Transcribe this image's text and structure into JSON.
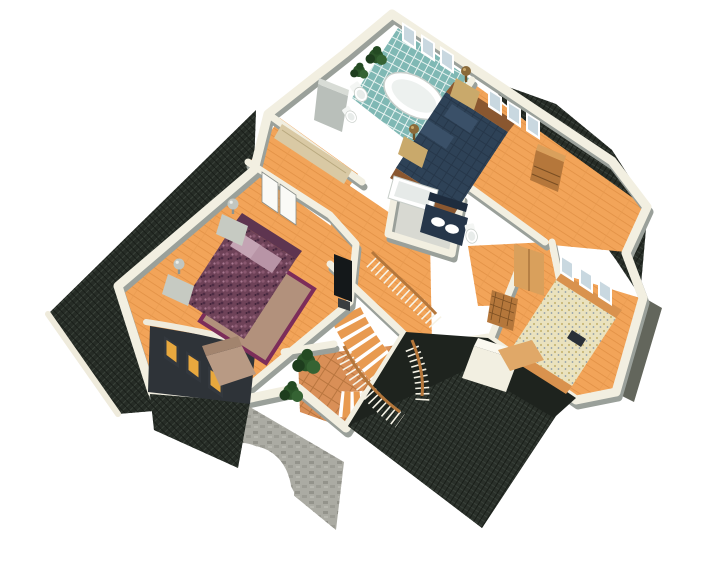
{
  "meta": {
    "title": "Isometric 3D cutaway render of a house second floor",
    "view": "aerial-isometric",
    "background": "#FFFFFF"
  },
  "palette": {
    "background": "#FFFFFF",
    "roof": "#262C26",
    "roof_flat": "#1E231E",
    "wall_cream": "#F2EFE1",
    "wall_gray": "#9AA09A",
    "wall_dark": "#63665C",
    "floor_wood": "#F2A459",
    "floor_terracotta": "#D98F57",
    "floor_gray": "#D8D9D2",
    "tile_teal": "#7FB8B4",
    "bed_navy": "#2E4257",
    "bed_purple": "#6E4258",
    "bed_cream": "#EAE2BE",
    "rug_tan": "#B2917C",
    "rug_border": "#7C2D5A",
    "stone": "#ABABA3",
    "amber_glass": "#E8A83E",
    "wood_trim": "#B5773B",
    "plant_green": "#2B5429",
    "fixture_white": "#FDFDFD"
  },
  "scene": {
    "rooms": [
      {
        "id": "master-bathroom",
        "floor": "teal-tile",
        "objects": [
          "oval-bathtub",
          "toilet",
          "bidet",
          "shower-stall",
          "potted-plants",
          "triple-window"
        ]
      },
      {
        "id": "master-bedroom",
        "floor": "wood",
        "objects": [
          "double-bed-navy",
          "wood-headboard",
          "nightstand",
          "nightstand",
          "bronze-table-lamps",
          "dresser",
          "triple-window"
        ]
      },
      {
        "id": "ensuite-bathroom",
        "floor": "gray",
        "objects": [
          "bathtub",
          "navy-double-sink-vanity",
          "mirror",
          "toilet"
        ]
      },
      {
        "id": "walk-in-closet",
        "floor": "wood",
        "objects": [
          "wall-shelf"
        ]
      },
      {
        "id": "hallway",
        "floor": "wood",
        "objects": [
          "curved-staircase",
          "stair-railings"
        ]
      },
      {
        "id": "bedroom-left",
        "floor": "wood",
        "objects": [
          "double-bed-purple",
          "area-rug",
          "nightstand",
          "nightstand",
          "ball-lamps",
          "tv-cabinet",
          "armchair",
          "arched-bay-window",
          "double-doors"
        ]
      },
      {
        "id": "bedroom-right",
        "floor": "wood",
        "objects": [
          "double-bed-patterned",
          "foot-bench",
          "lattice-dresser",
          "sliding-closet-doors",
          "triple-window",
          "dark-bag-on-bed"
        ]
      },
      {
        "id": "stair-landing",
        "floor": "terracotta-tile",
        "objects": [
          "potted-plants",
          "lower-stair-flight"
        ]
      }
    ],
    "exterior": [
      "left-shingle-roof",
      "bay-window-dormer",
      "amber-windows",
      "stone-archway",
      "garage-flat-roof",
      "garage-shingle-slope",
      "chimney",
      "right-turret-shingle-roof",
      "top-right-shingle-roof"
    ]
  }
}
